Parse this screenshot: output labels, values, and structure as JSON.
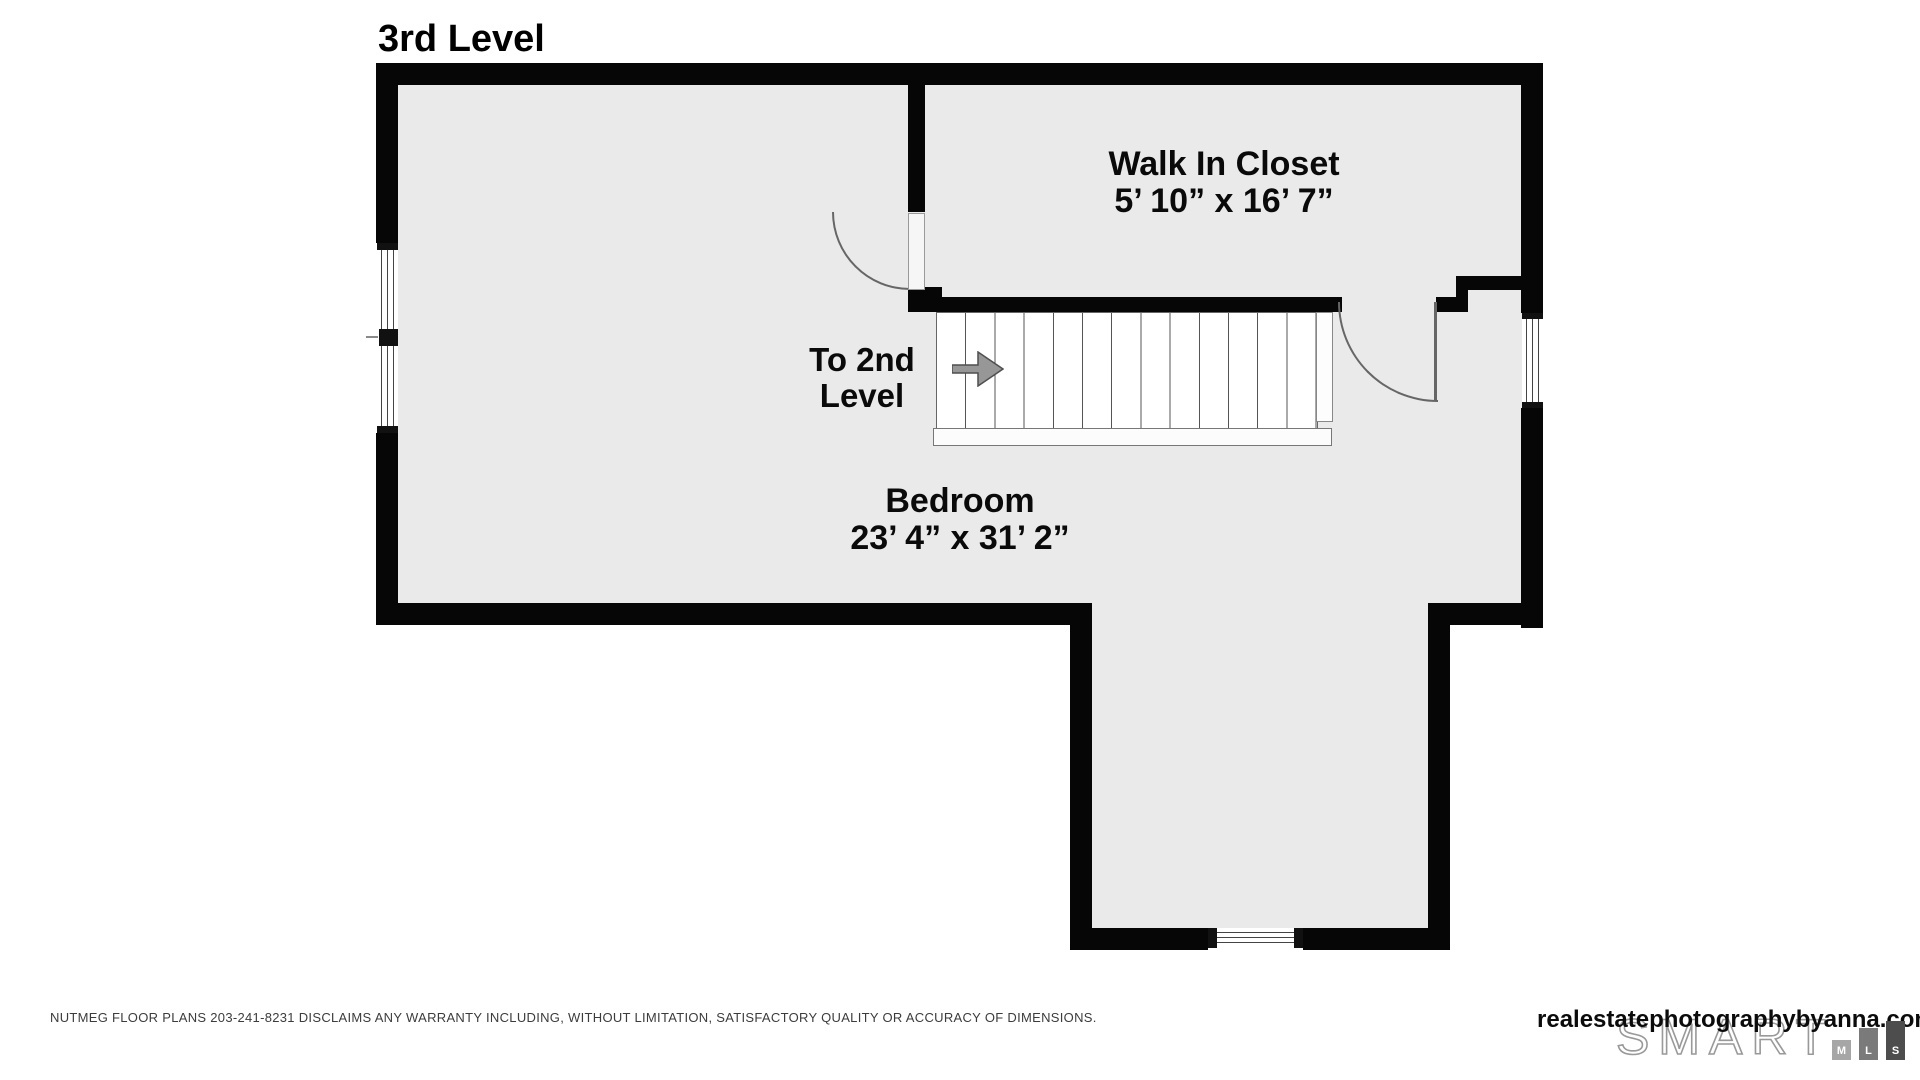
{
  "title": "3rd Level",
  "rooms": [
    {
      "name": "Walk In Closet",
      "dimensions": "5’ 10” x 16’ 7”"
    },
    {
      "name": "Bedroom",
      "dimensions": "23’ 4” x 31’ 2”"
    }
  ],
  "stairs": {
    "label_line1": "To 2nd",
    "label_line2": "Level",
    "direction": "right",
    "tread_count": 13
  },
  "colors": {
    "wall": "#060606",
    "floor": "#eaeaea",
    "arrow_fill": "#979797",
    "arrow_stroke": "#4f4f4f",
    "mls_bar_m": "#a6a6a6",
    "mls_bar_l": "#7a7a7a",
    "mls_bar_s": "#4d4d4d"
  },
  "footer": {
    "disclaimer": "NUTMEG FLOOR PLANS 203-241-8231 DISCLAIMS ANY WARRANTY INCLUDING, WITHOUT LIMITATION, SATISFACTORY QUALITY OR ACCURACY OF DIMENSIONS.",
    "website": "realestatephotographybyanna.com",
    "logo_text": "SMART",
    "logo_letters": [
      "M",
      "L",
      "S"
    ]
  }
}
